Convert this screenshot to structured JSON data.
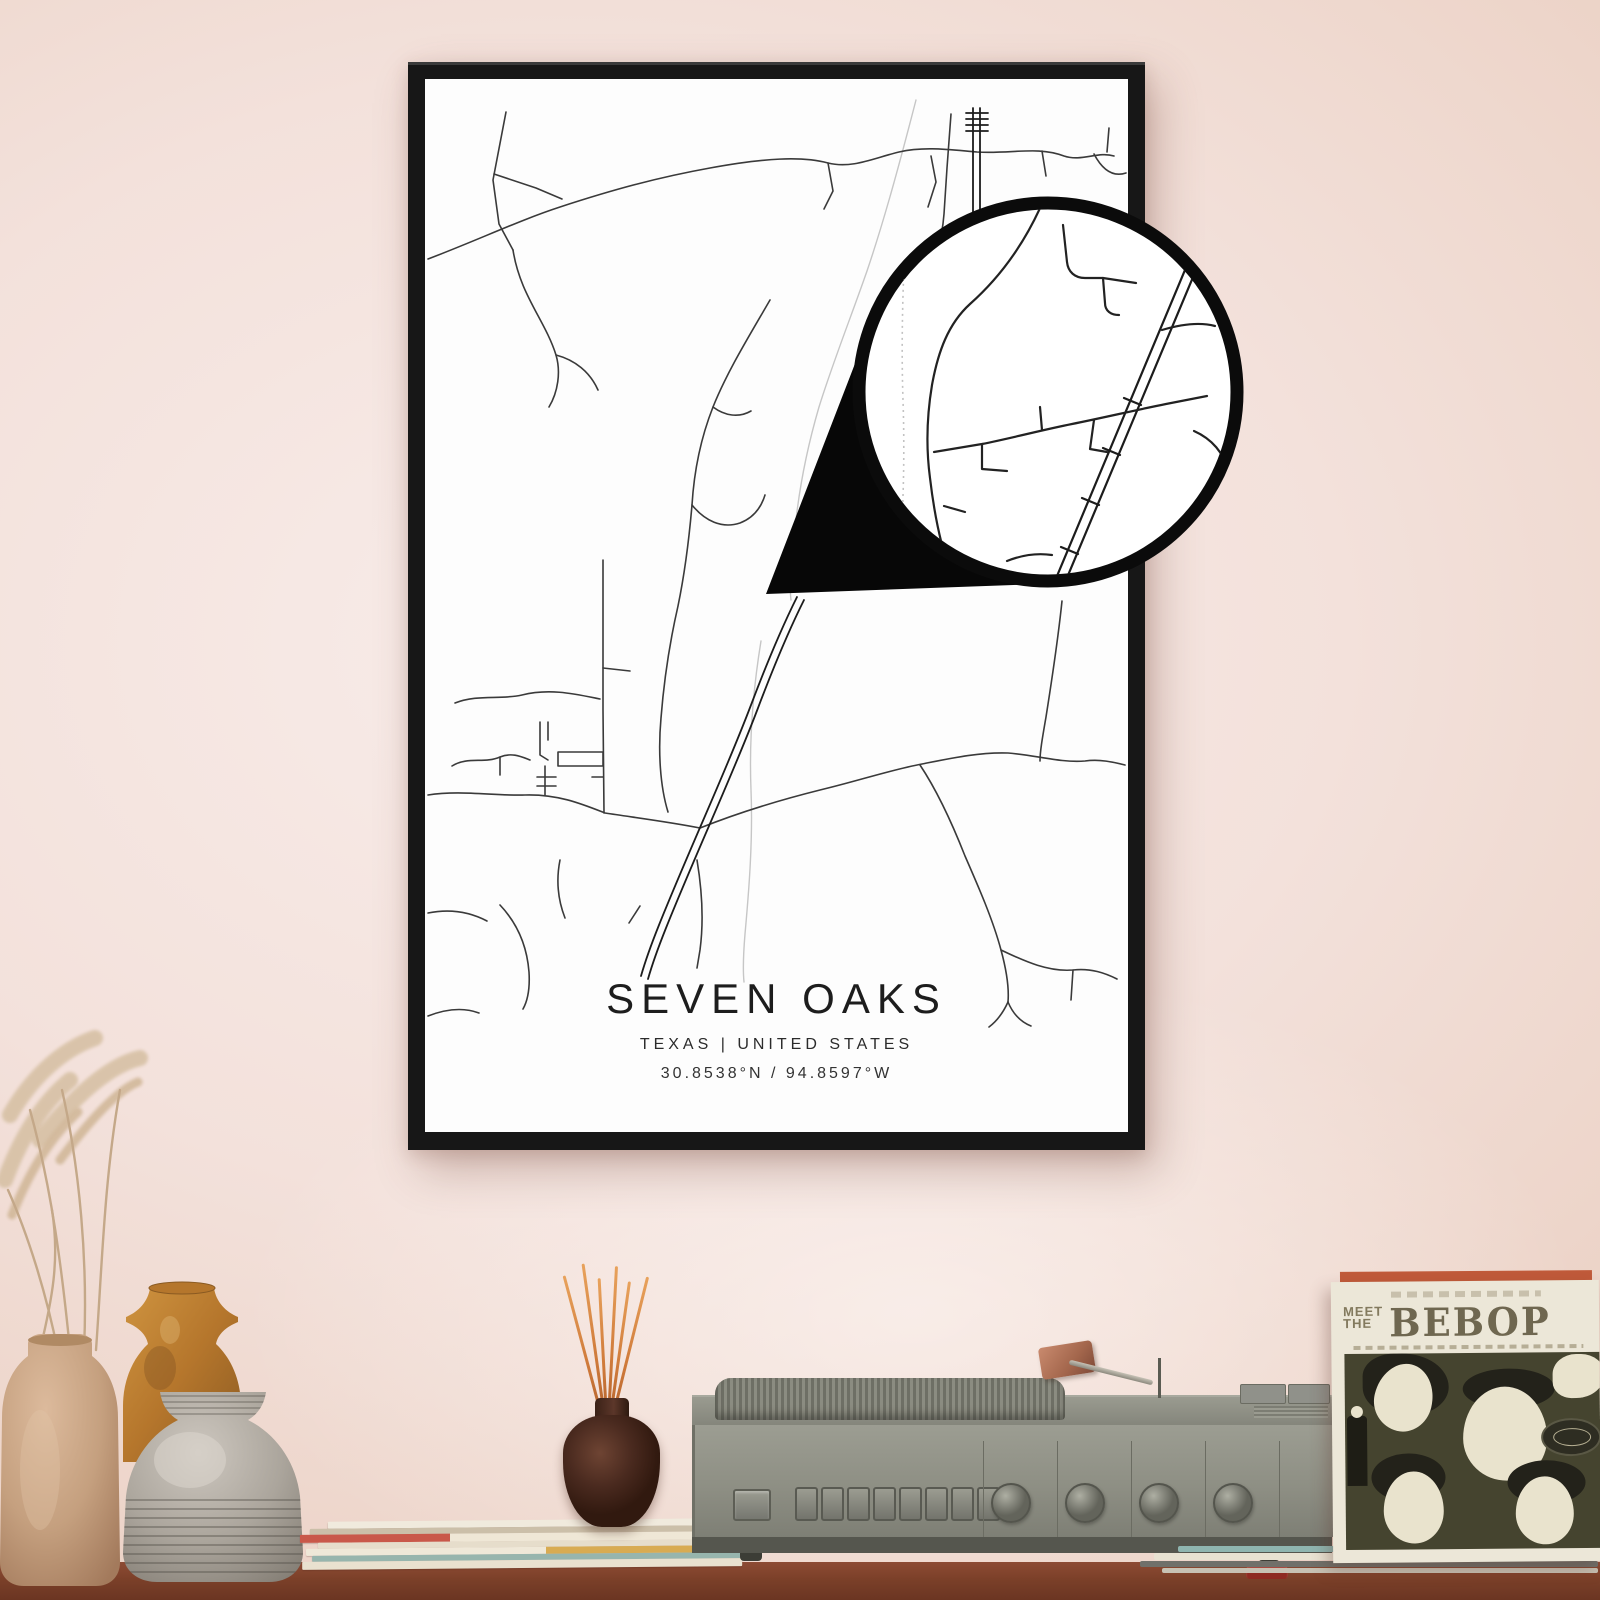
{
  "poster": {
    "title": "SEVEN OAKS",
    "region": "TEXAS | UNITED STATES",
    "coordinates": "30.8538°N / 94.8597°W",
    "colors": {
      "frame": "#171717",
      "paper": "#fdfdfd",
      "road_dark": "#3a3a3a",
      "road_light": "#c6c6c6",
      "railroad": "#1c1c1c",
      "callout_border": "#0b0b0b",
      "callout_fill": "#ffffff",
      "pointer_wedge": "#070707"
    }
  },
  "record_sleeve": {
    "meet": "MEET",
    "the": "THE",
    "band": "BEBOP",
    "colors": {
      "cover": "#ece7d8",
      "art_background": "#45442f",
      "lettering": "#6f6750"
    }
  },
  "scene": {
    "wall_color": "#f3e1db",
    "table_color": "#7b4029",
    "player_color": "#8e8f84",
    "incense_stick_color": "#cf7a3a"
  }
}
